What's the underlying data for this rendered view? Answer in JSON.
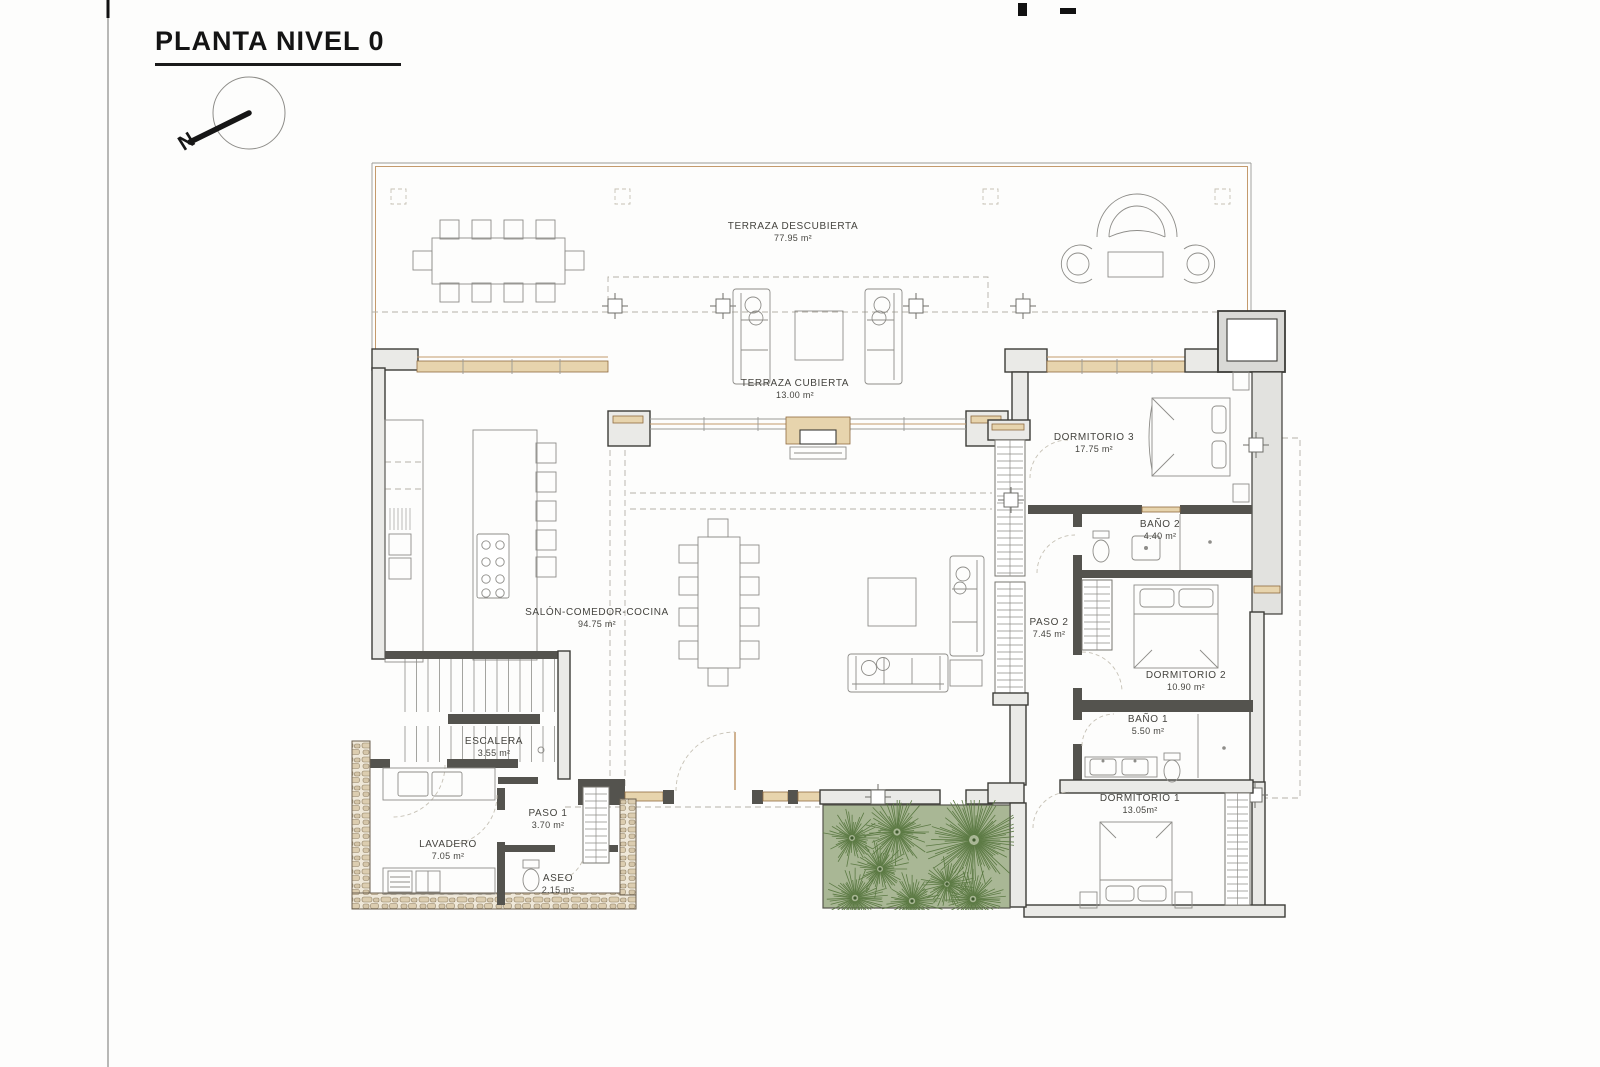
{
  "page": {
    "title": "PLANTA NIVEL 0",
    "north_label": "N"
  },
  "rooms": {
    "terraza_descubierta": {
      "name": "TERRAZA DESCUBIERTA",
      "area": "77.95 m²"
    },
    "terraza_cubierta": {
      "name": "TERRAZA CUBIERTA",
      "area": "13.00 m²"
    },
    "salon": {
      "name": "SALÓN-COMEDOR-COCINA",
      "area": "94.75 m²"
    },
    "escalera": {
      "name": "ESCALERA",
      "area": "3.55 m²"
    },
    "paso1": {
      "name": "PASO 1",
      "area": "3.70 m²"
    },
    "lavadero": {
      "name": "LAVADERO",
      "area": "7.05 m²"
    },
    "aseo": {
      "name": "ASEO",
      "area": "2.15 m²"
    },
    "dormitorio3": {
      "name": "DORMITORIO 3",
      "area": "17.75 m²"
    },
    "bano2": {
      "name": "BAÑO 2",
      "area": "4.40 m²"
    },
    "paso2": {
      "name": "PASO 2",
      "area": "7.45 m²"
    },
    "dormitorio2": {
      "name": "DORMITORIO 2",
      "area": "10.90 m²"
    },
    "bano1": {
      "name": "BAÑO 1",
      "area": "5.50 m²"
    },
    "dormitorio1": {
      "name": "DORMITORIO 1",
      "area": "13.05m²"
    }
  },
  "colors": {
    "wall": "#3d3c38",
    "wall_fill": "#eaeae7",
    "accent_tan": "#c49a6c",
    "window_fill": "#e7d4ad",
    "garden_green": "#a9b795",
    "plant_green": "#5c7a44"
  }
}
